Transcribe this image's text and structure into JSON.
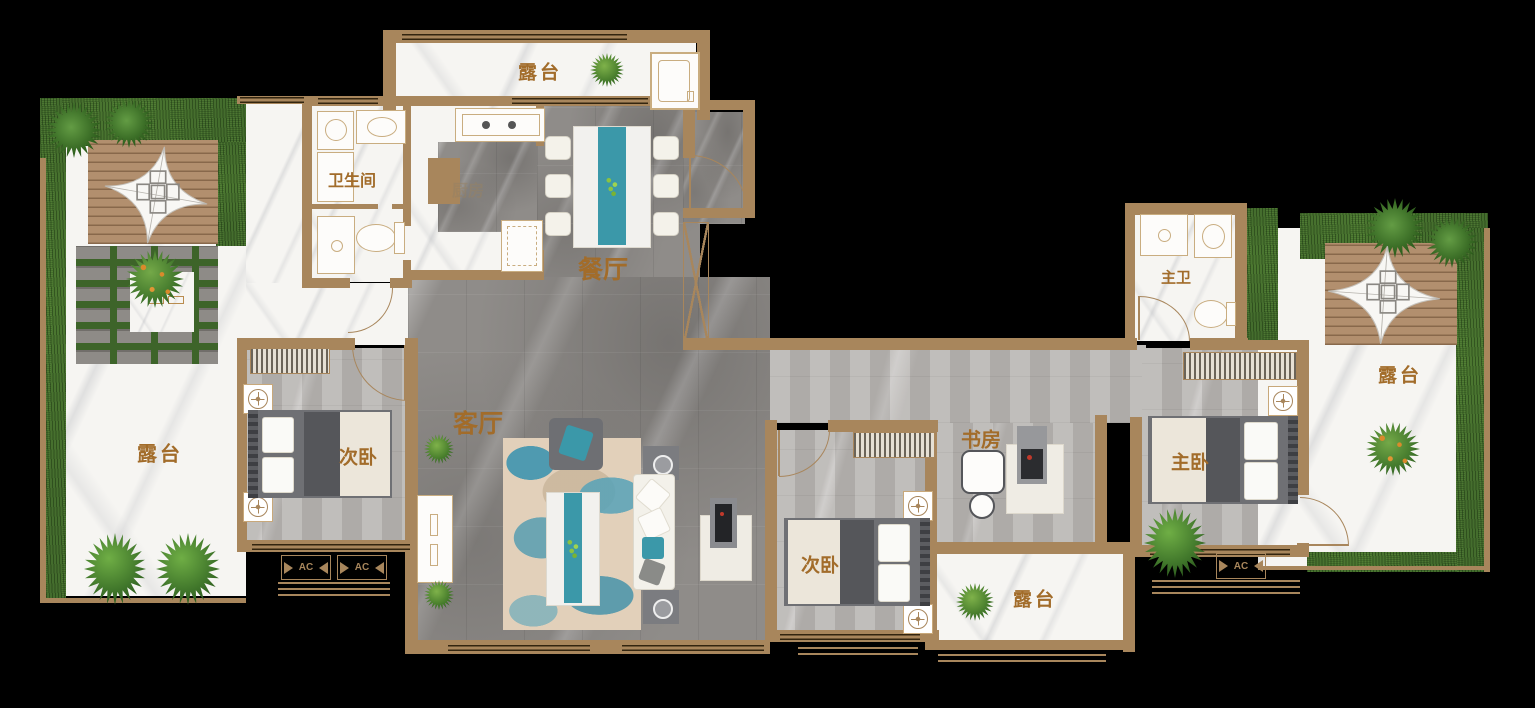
{
  "plan": {
    "title": "apartment-floor-plan",
    "labels": {
      "terrace_top": "露台",
      "terrace_left": "露台",
      "terrace_bottom": "露台",
      "terrace_right": "露台",
      "bathroom": "卫生间",
      "kitchen": "厨房",
      "dining": "餐厅",
      "living": "客厅",
      "bedroom_left": "次卧",
      "bedroom_mid": "次卧",
      "study": "书房",
      "master_bath": "主卫",
      "master_bedroom": "主卧",
      "ac1": "AC",
      "ac2": "AC",
      "ac3": "AC"
    },
    "colors": {
      "wall": "#a8865c",
      "label": "#a26c2a",
      "teal": "#3b98a9",
      "grass": "#3d6429",
      "deck": "#b28f6e",
      "floor_gray": "#8f8c89",
      "floor_light": "#b7b4b1",
      "marble": "#f6f5f2"
    }
  }
}
